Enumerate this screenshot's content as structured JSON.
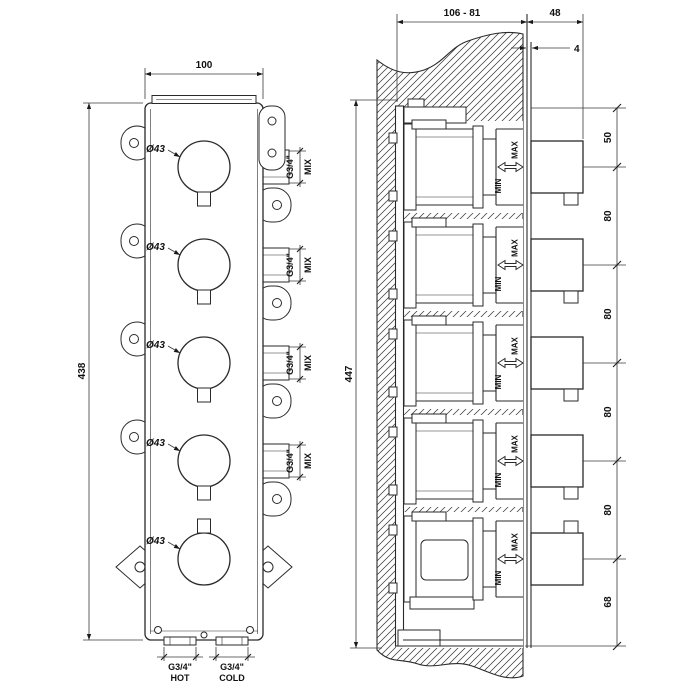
{
  "front_view": {
    "width": "100",
    "height": "438",
    "knobs": [
      {
        "dia": "Ø43"
      },
      {
        "dia": "Ø43"
      },
      {
        "dia": "Ø43"
      },
      {
        "dia": "Ø43"
      },
      {
        "dia": "Ø43"
      }
    ],
    "outlets": [
      {
        "thread": "G3/4\"",
        "label": "MIX"
      },
      {
        "thread": "G3/4\"",
        "label": "MIX"
      },
      {
        "thread": "G3/4\"",
        "label": "MIX"
      },
      {
        "thread": "G3/4\"",
        "label": "MIX"
      }
    ],
    "inlet_hot": {
      "thread": "G3/4\"",
      "label": "HOT"
    },
    "inlet_cold": {
      "thread": "G3/4\"",
      "label": "COLD"
    }
  },
  "section_view": {
    "depth_range": "106 - 81",
    "handle_depth": "48",
    "plate_gap": "4",
    "height": "447",
    "spacing_chain": [
      "50",
      "80",
      "80",
      "80",
      "80",
      "68"
    ],
    "travel_markers": [
      {
        "min": "MIN",
        "max": "MAX"
      },
      {
        "min": "MIN",
        "max": "MAX"
      },
      {
        "min": "MIN",
        "max": "MAX"
      },
      {
        "min": "MIN",
        "max": "MAX"
      },
      {
        "min": "MIN",
        "max": "MAX"
      }
    ]
  },
  "colors": {
    "line": "#2a2a2a",
    "background": "#ffffff"
  }
}
